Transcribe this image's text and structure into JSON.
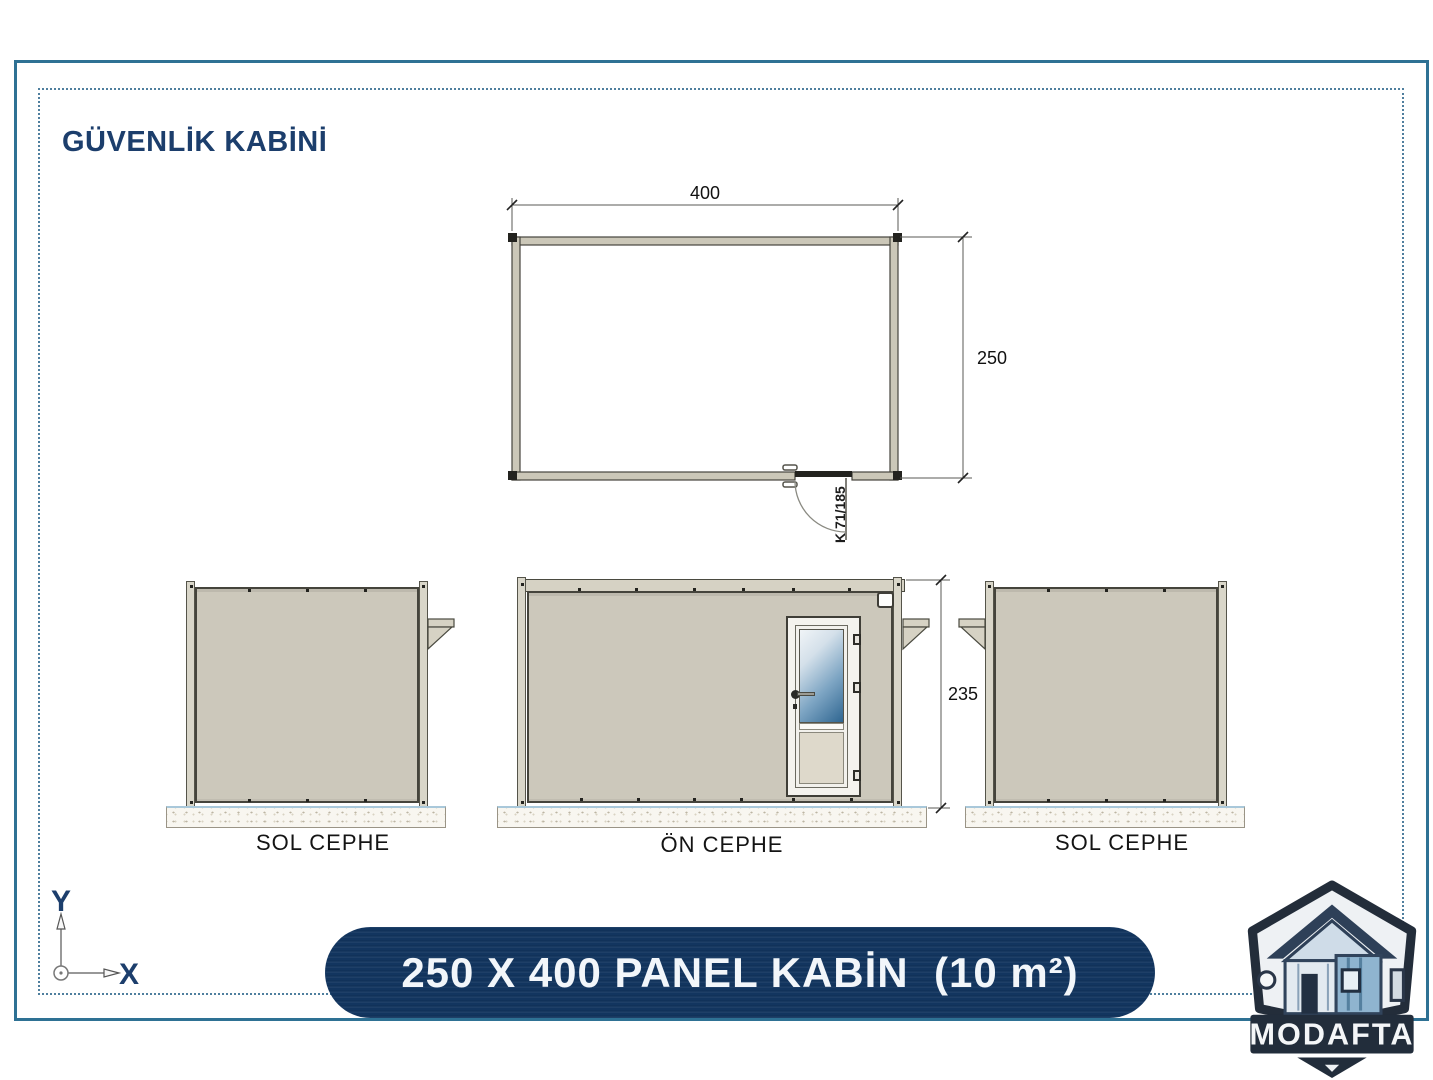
{
  "title": "GÜVENLİK KABİNİ",
  "plan": {
    "width_label": "400",
    "depth_label": "250",
    "door_label": "K 71/185"
  },
  "elevations": {
    "left": {
      "label": "SOL CEPHE"
    },
    "front": {
      "label": "ÖN CEPHE",
      "height_label": "235"
    },
    "right": {
      "label": "SOL CEPHE"
    }
  },
  "footer": {
    "banner_text": "250 X 400 PANEL KABİN  (10 m²)"
  },
  "logo": {
    "brand": "MODAFTA"
  },
  "axes": {
    "x_label": "X",
    "y_label": "Y"
  },
  "colors": {
    "navy": "#12355f",
    "title_navy": "#1c3e6c",
    "frame_teal": "#2e7194",
    "panel_beige": "#ccc8bb",
    "glass_blue": "#2f6691"
  }
}
